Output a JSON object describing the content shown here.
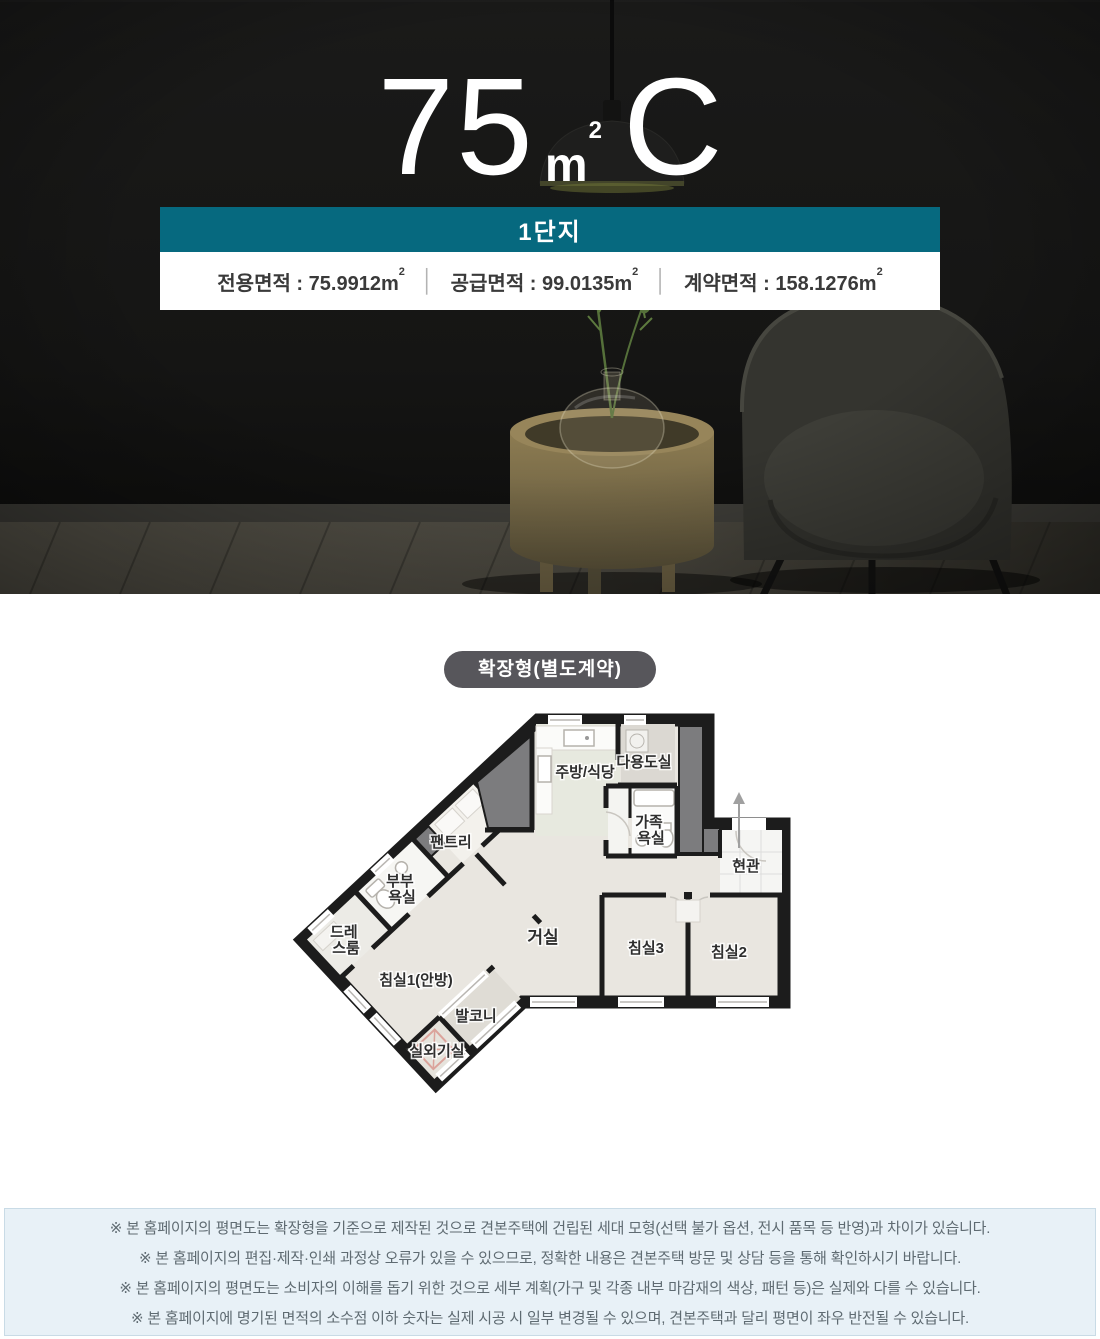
{
  "hero": {
    "title_number": "75",
    "unit_base": "m",
    "unit_sup": "2",
    "title_type": "C",
    "banner": "1단지",
    "label_value_sep": " : ",
    "divider": "│",
    "areas": [
      {
        "label": "전용면적",
        "value": "75.9912"
      },
      {
        "label": "공급면적",
        "value": "99.0135"
      },
      {
        "label": "계약면적",
        "value": "158.1276"
      }
    ]
  },
  "plan": {
    "badge": "확장형(별도계약)",
    "rooms": {
      "kitchen": "주방/식당",
      "utility": "다용도실",
      "family_bath_l1": "가족",
      "family_bath_l2": "욕실",
      "entrance": "현관",
      "living": "거실",
      "bedroom3": "침실3",
      "bedroom2": "침실2",
      "bedroom1": "침실1(안방)",
      "pantry": "팬트리",
      "master_bath_l1": "부부",
      "master_bath_l2": "욕실",
      "dress_l1": "드레",
      "dress_l2": "스룸",
      "balcony": "발코니",
      "outdoor_unit": "실외기실"
    }
  },
  "notice": {
    "lines": [
      "※ 본 홈페이지의 평면도는 확장형을 기준으로 제작된 것으로 견본주택에 건립된 세대 모형(선택 불가 옵션, 전시 품목 등 반영)과 차이가 있습니다.",
      "※ 본 홈페이지의 편집·제작·인쇄 과정상 오류가 있을 수 있으므로, 정확한 내용은 견본주택 방문 및 상담 등을 통해 확인하시기 바랍니다.",
      "※ 본 홈페이지의 평면도는 소비자의 이해를 돕기 위한 것으로 세부 계획(가구 및 각종 내부 마감재의 색상, 패턴 등)은 실제와 다를 수 있습니다.",
      "※ 본 홈페이지에 명기된 면적의 소수점 이하 숫자는 실제 시공 시 일부 변경될 수 있으며, 견본주택과 달리 평면이 좌우 반전될 수 있습니다."
    ]
  },
  "colors": {
    "accent_teal": "#06697f",
    "badge_bg": "#57565b",
    "notice_bg": "#e8f1f7",
    "wall_black": "#1c1c1c",
    "core_gray": "#7c7c7e",
    "floor_beige": "#e9e6e0"
  }
}
